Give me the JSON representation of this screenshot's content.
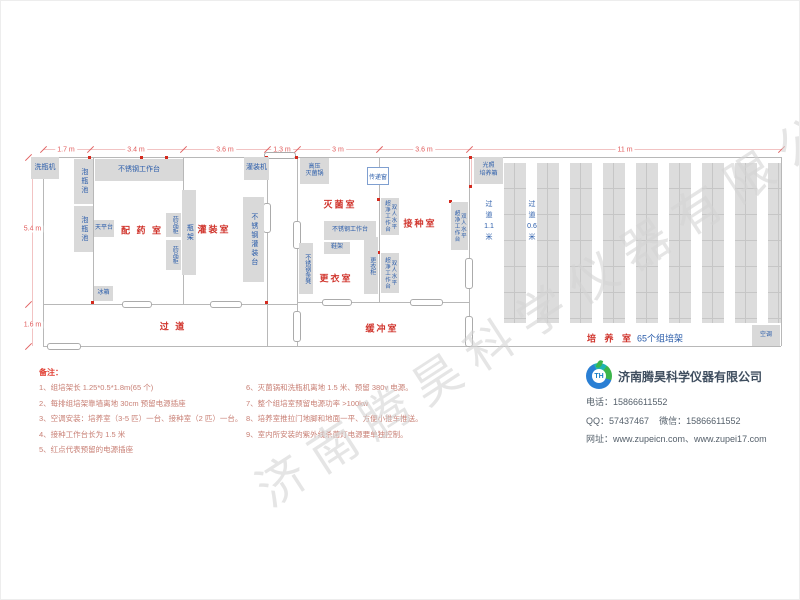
{
  "watermark": "济南腾昊科学仪器有限公司",
  "colors": {
    "room_label": "#d0342c",
    "equipment_text": "#2a5caa",
    "equipment_fill": "#d9d9d9",
    "wall": "#b8b8b8",
    "dimension_text": "#e05a5a",
    "outlet_dot": "#d42a1e",
    "note_header": "#e03b2f",
    "note_text": "#c87f74",
    "company_name": "#3f4e5f"
  },
  "dims": {
    "top": [
      {
        "label": "1.7 m",
        "cx": 65
      },
      {
        "label": "3.4 m",
        "cx": 135
      },
      {
        "label": "3.6 m",
        "cx": 224
      },
      {
        "label": "1.3 m",
        "cx": 281
      },
      {
        "label": "3 m",
        "cx": 337
      },
      {
        "label": "3.6 m",
        "cx": 423
      },
      {
        "label": "11 m",
        "cx": 624
      }
    ],
    "left": [
      {
        "label": "5.4 m",
        "cy": 228
      },
      {
        "label": "1.6 m",
        "cy": 324
      }
    ]
  },
  "rooms": [
    {
      "name": "dispensing-room",
      "label": "配 药 室",
      "cx": 141,
      "cy": 229
    },
    {
      "name": "filling-room",
      "label": "灌装室",
      "cx": 213,
      "cy": 228
    },
    {
      "name": "sterilization-room",
      "label": "灭菌室",
      "cx": 339,
      "cy": 203
    },
    {
      "name": "inoculation-room",
      "label": "接种室",
      "cx": 419,
      "cy": 222
    },
    {
      "name": "changing-room",
      "label": "更衣室",
      "cx": 335,
      "cy": 277
    },
    {
      "name": "corridor",
      "label": "过    道",
      "cx": 172,
      "cy": 325
    },
    {
      "name": "buffer-room",
      "label": "缓冲室",
      "cx": 381,
      "cy": 327
    }
  ],
  "culture_room": {
    "label_red": "培 养 室",
    "label_blue": "65个组培架",
    "cx": 634,
    "cy": 337,
    "aisles": [
      {
        "name": "aisle-1-1m",
        "text": "过\n道\n1.1\n米",
        "cx": 488,
        "y": 198
      },
      {
        "name": "aisle-0-6m",
        "text": "过\n道\n0.6\n米",
        "cx": 531,
        "y": 198
      }
    ]
  },
  "equipment": [
    {
      "name": "bottle-washer",
      "label": "洗瓶机",
      "x": 30,
      "y": 156,
      "w": 28,
      "h": 22,
      "cls": ""
    },
    {
      "name": "soak-pool-1",
      "label": "泡瓶池",
      "x": 73,
      "y": 158,
      "w": 19,
      "h": 45,
      "cls": "v"
    },
    {
      "name": "soak-pool-2",
      "label": "泡瓶池",
      "x": 73,
      "y": 205,
      "w": 19,
      "h": 46,
      "cls": "v"
    },
    {
      "name": "ss-workbench-prep",
      "label": "不锈钢工作台",
      "x": 94,
      "y": 158,
      "w": 88,
      "h": 22,
      "cls": ""
    },
    {
      "name": "balance-table",
      "label": "天平台",
      "x": 93,
      "y": 219,
      "w": 20,
      "h": 17,
      "cls": "s"
    },
    {
      "name": "medicine-cabinet-1",
      "label": "药品柜",
      "x": 165,
      "y": 212,
      "w": 15,
      "h": 24,
      "cls": "v s"
    },
    {
      "name": "medicine-cabinet-2",
      "label": "药品柜",
      "x": 165,
      "y": 239,
      "w": 15,
      "h": 30,
      "cls": "v s"
    },
    {
      "name": "bottle-rack",
      "label": "瓶架",
      "x": 181,
      "y": 189,
      "w": 14,
      "h": 85,
      "cls": "v"
    },
    {
      "name": "fridge",
      "label": "冰箱",
      "x": 93,
      "y": 285,
      "w": 19,
      "h": 15,
      "cls": "s"
    },
    {
      "name": "filling-machine",
      "label": "灌装机",
      "x": 243,
      "y": 156,
      "w": 25,
      "h": 23,
      "cls": ""
    },
    {
      "name": "ss-filling-table",
      "label": "不锈钢灌装台",
      "x": 242,
      "y": 196,
      "w": 21,
      "h": 85,
      "cls": "v"
    },
    {
      "name": "autoclave",
      "label": "高压\n灭菌锅",
      "x": 299,
      "y": 157,
      "w": 29,
      "h": 26,
      "cls": "s"
    },
    {
      "name": "ss-workbench-steril",
      "label": "不锈钢工作台",
      "x": 323,
      "y": 220,
      "w": 52,
      "h": 19,
      "cls": "s"
    },
    {
      "name": "shoe-rack",
      "label": "鞋架",
      "x": 323,
      "y": 241,
      "w": 26,
      "h": 12,
      "cls": "s"
    },
    {
      "name": "ss-bench",
      "label": "不锈钢条凳",
      "x": 298,
      "y": 242,
      "w": 14,
      "h": 51,
      "cls": "v s"
    },
    {
      "name": "wardrobe",
      "label": "更衣柜",
      "x": 363,
      "y": 236,
      "w": 14,
      "h": 57,
      "cls": "v s"
    },
    {
      "name": "laminar-flow-bench-1",
      "label": "双人水平\n超净工作台",
      "x": 380,
      "y": 197,
      "w": 18,
      "h": 37,
      "cls": "v xs"
    },
    {
      "name": "laminar-flow-bench-2",
      "label": "双人水平\n超净工作台",
      "x": 380,
      "y": 252,
      "w": 18,
      "h": 40,
      "cls": "v xs"
    },
    {
      "name": "laminar-flow-bench-3",
      "label": "双人水平\n超净工作台",
      "x": 450,
      "y": 201,
      "w": 17,
      "h": 48,
      "cls": "v xs"
    },
    {
      "name": "light-incubator",
      "label": "光照\n培养箱",
      "x": 473,
      "y": 156,
      "w": 29,
      "h": 27,
      "cls": "s"
    },
    {
      "name": "air-conditioner",
      "label": "空调",
      "x": 751,
      "y": 324,
      "w": 28,
      "h": 21,
      "cls": "s"
    }
  ],
  "pass_window": {
    "name": "pass-window",
    "label": "传递窗",
    "x": 366,
    "y": 166,
    "w": 22,
    "h": 18
  },
  "notes": {
    "header": "备注：",
    "col1": [
      "1、组培架长 1.25*0.5*1.8m(65 个)",
      "2、每排组培架靠墙离地 30cm 预留电源插座",
      "3、空调安装：培养室（3-5 匹）一台、接种室（2 匹）一台。",
      "4、接种工作台长为 1.5 米",
      "5、红点代表预留的电源插座"
    ],
    "col2": [
      "6、灭菌锅和洗瓶机离地 1.5 米、预留 380v 电源。",
      "7、整个组培室预留电源功率 >100kw",
      "8、培养室推拉门地脚和地面一平、方便小推车推送。",
      "9、室内所安装的紫外线杀菌灯电源要单独控制。"
    ]
  },
  "company": {
    "logo_text": "TH",
    "name": "济南腾昊科学仪器有限公司",
    "phone_label": "电话：",
    "phone": "15866611552",
    "qq_label": "QQ：",
    "qq": "57437467",
    "wechat_label": "微信：",
    "wechat": "15866611552",
    "web_label": "网址：",
    "web": "www.zupeicn.com、www.zupei17.com"
  }
}
